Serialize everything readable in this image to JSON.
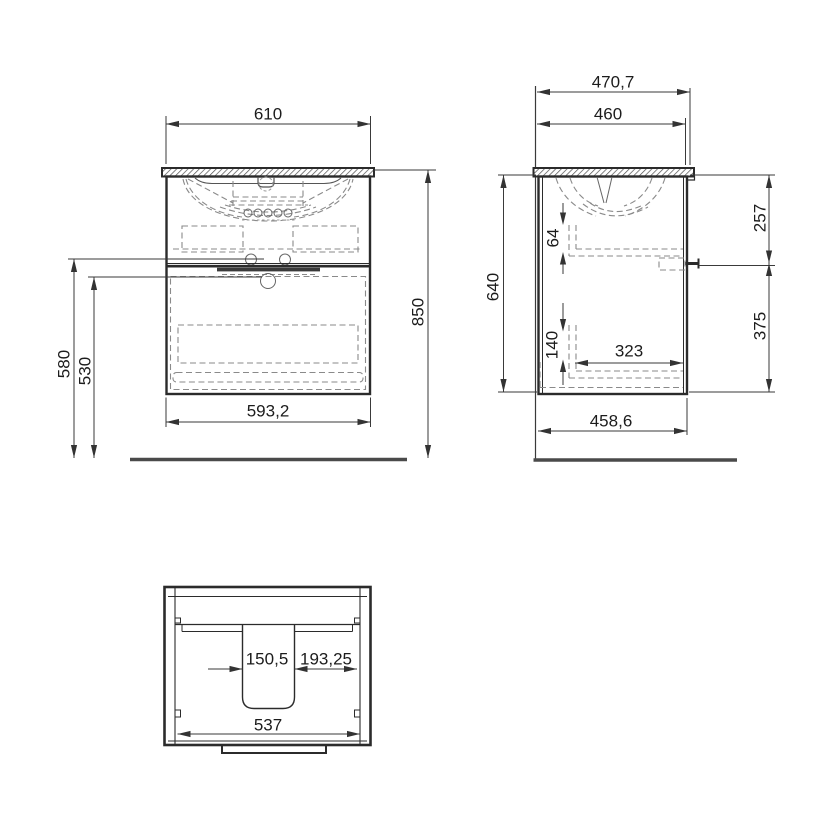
{
  "drawing": {
    "title": "Vanity unit with washbasin - dimensioned technical drawing",
    "type": "technical-drawing",
    "units": "mm",
    "colors": {
      "background": "#ffffff",
      "outline": "#2b2b2b",
      "dashed": "#8a8a8a",
      "dimension": "#3a3a3a",
      "floor": "#4a4a4a"
    },
    "views": {
      "front": {
        "label": "front-view",
        "dims": {
          "width_top": "610",
          "width_bottom": "593,2",
          "height_total": "850",
          "height_upper": "580",
          "height_lower": "530"
        }
      },
      "side": {
        "label": "side-view",
        "dims": {
          "depth_total": "470,7",
          "depth_body": "460",
          "height_body": "640",
          "inset_upper": "64",
          "inset_lower": "140",
          "inner_depth": "323",
          "top_to_bracket": "257",
          "bracket_to_bottom": "375",
          "depth_bottom": "458,6"
        }
      },
      "top": {
        "label": "top-view",
        "dims": {
          "cutout_width": "150,5",
          "cutout_to_side": "193,25",
          "inner_width": "537"
        }
      }
    }
  }
}
